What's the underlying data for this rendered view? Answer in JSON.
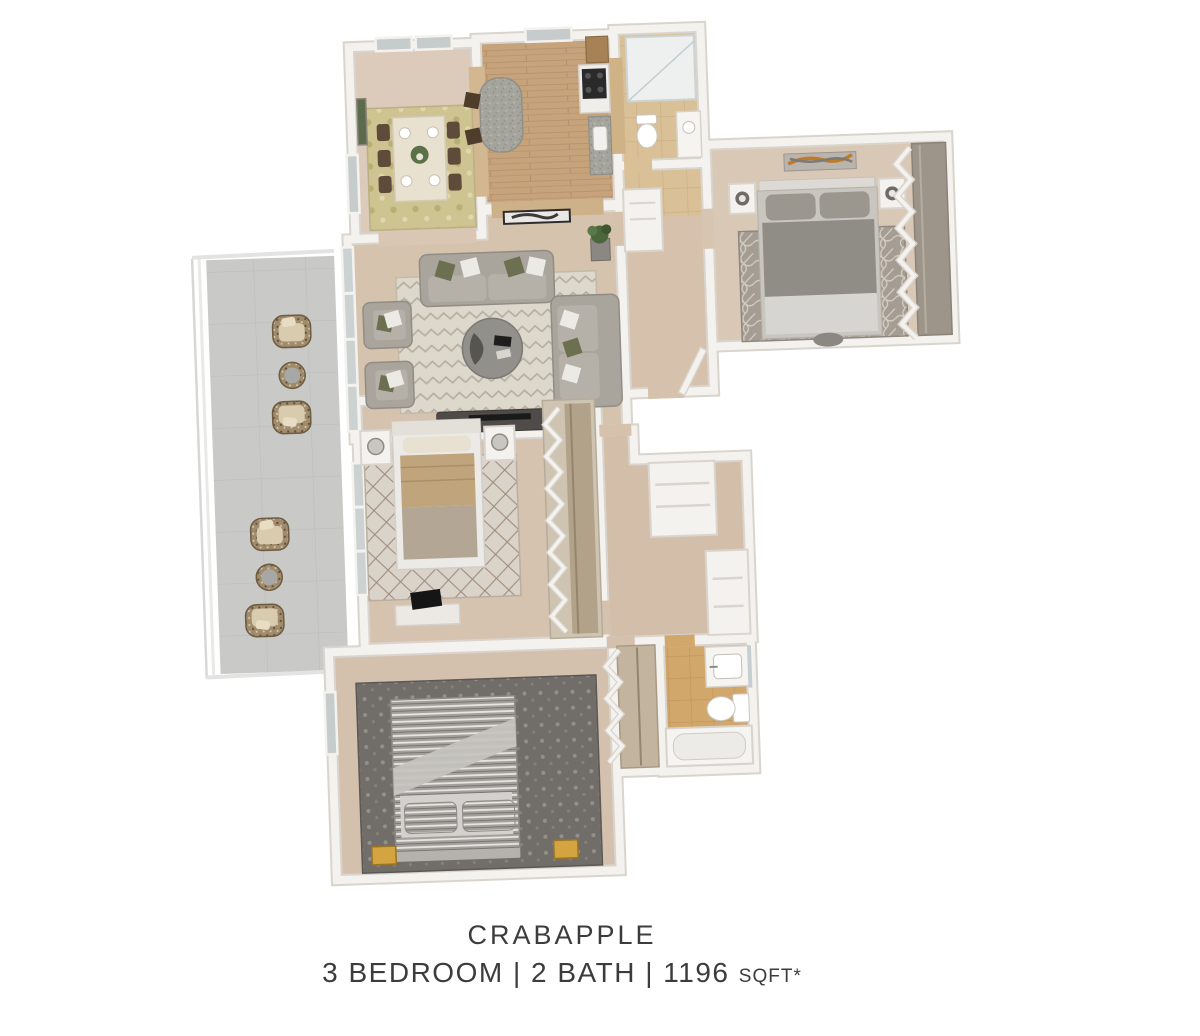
{
  "caption": {
    "title": "CRABAPPLE",
    "specs": "3 BEDROOM | 2 BATH | 1196",
    "sqft": "SQFT*"
  },
  "floor_plan": {
    "view": "3d-top-down-apartment-floor-plan",
    "unit": {
      "name": "Crabapple",
      "bedrooms": 3,
      "bathrooms": 2,
      "square_feet": 1196
    },
    "rooms": [
      {
        "name": "dining-room",
        "features": [
          "dining-table",
          "six-dark-chairs",
          "place-settings",
          "centerpiece-plant",
          "damask-rug",
          "green-wall-art",
          "windows"
        ]
      },
      {
        "name": "kitchen",
        "features": [
          "granite-island",
          "two-bar-stools",
          "range-with-cooktop",
          "wood-pantry-cabinet",
          "counter-with-sink",
          "wood-plank-floor",
          "window"
        ]
      },
      {
        "name": "bathroom-1",
        "features": [
          "shower-tub",
          "toilet",
          "vanity",
          "tile-floor"
        ]
      },
      {
        "name": "entry",
        "features": [
          "front-door",
          "coat-closet",
          "feather-wall-art",
          "potted-plant"
        ]
      },
      {
        "name": "master-bedroom",
        "features": [
          "bed",
          "two-nightstands",
          "two-lamps",
          "abstract-wall-art",
          "trellis-rug",
          "bifold-closet",
          "bench"
        ]
      },
      {
        "name": "living-room",
        "features": [
          "sofa",
          "two-armchairs",
          "loveseat",
          "round-coffee-table",
          "chevron-rug",
          "media-console",
          "glass-wall-to-balcony"
        ]
      },
      {
        "name": "bedroom-2",
        "features": [
          "bed",
          "two-nightstands",
          "two-lamps",
          "diamond-rug",
          "desk",
          "monitor",
          "bifold-closet"
        ]
      },
      {
        "name": "hallway",
        "features": [
          "linen-closet",
          "storage-closet"
        ]
      },
      {
        "name": "bedroom-3",
        "features": [
          "striped-bed",
          "two-striped-pillows",
          "dark-patterned-rug",
          "two-gold-benches",
          "bifold-closet",
          "window"
        ]
      },
      {
        "name": "bathroom-2",
        "features": [
          "bathtub",
          "toilet",
          "vanity-with-sink",
          "mirror",
          "tile-floor"
        ]
      },
      {
        "name": "balcony",
        "features": [
          "four-wicker-chairs",
          "two-round-wicker-tables",
          "glass-railing",
          "concrete-floor"
        ]
      }
    ]
  },
  "colors": {
    "background": "#ffffff",
    "wall": "#f4f2ee",
    "wall_shadow": "#d9d4cd",
    "carpet_tan": "#d7c4b0",
    "wood_floor": "#c7a37c",
    "tile_bath": "#d2a76b",
    "balcony_concrete": "#c9c9c7",
    "sofa_gray": "#a9a59d",
    "bed_gray": "#908c86",
    "olive_pillow": "#6a7050",
    "gold_bench": "#d4a440",
    "text": "#3c3c3c"
  }
}
